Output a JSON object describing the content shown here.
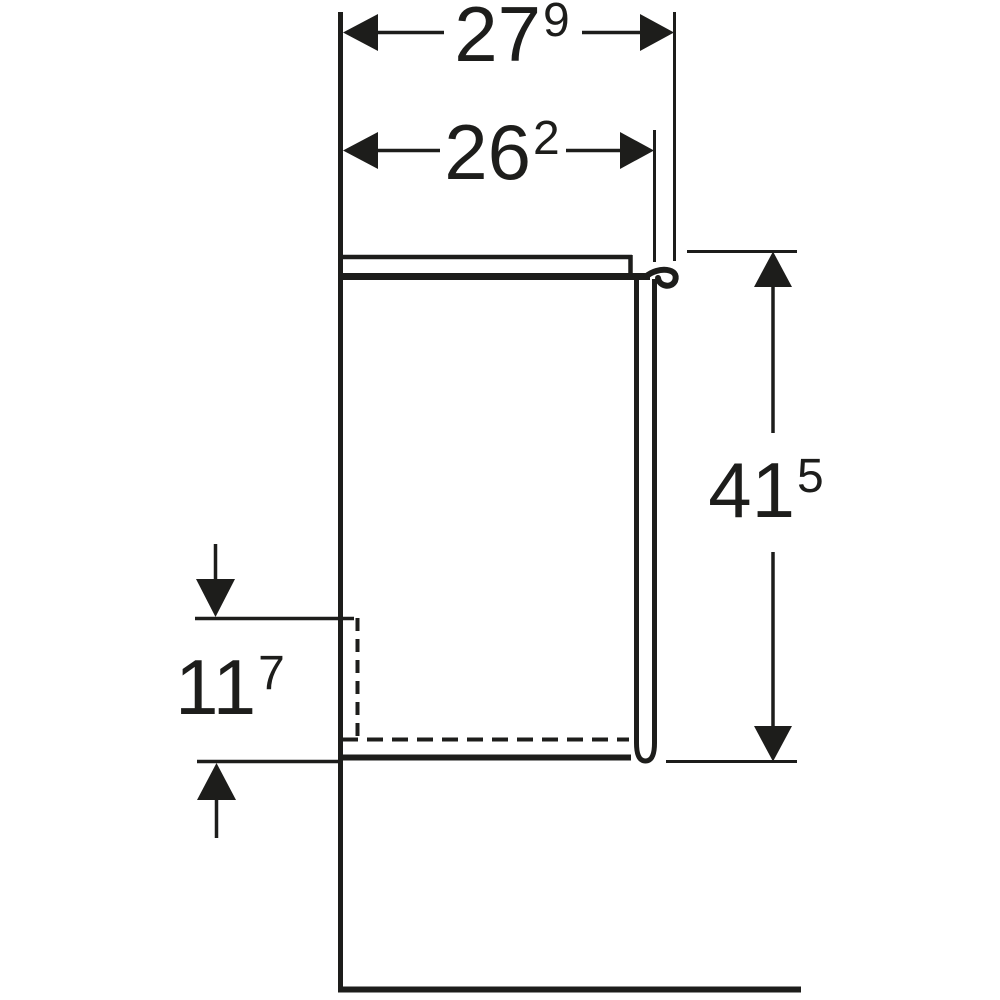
{
  "figure": {
    "background_color": "#ffffff",
    "line_color": "#1d1d1b",
    "view": "side-section-dimension-drawing"
  },
  "dimensions": {
    "top_outer": {
      "main": "27",
      "sup": "9"
    },
    "top_inner": {
      "main": "26",
      "sup": "2"
    },
    "right_height": {
      "main": "41",
      "sup": "5"
    },
    "left_cutout": {
      "main": "11",
      "sup": "7"
    }
  }
}
